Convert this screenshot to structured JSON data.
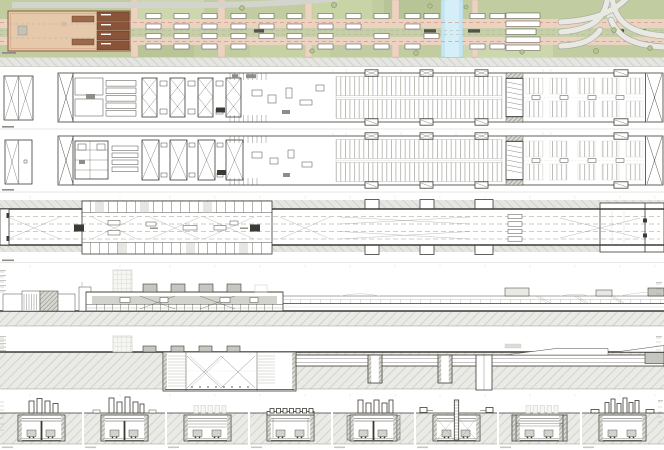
{
  "sheet": {
    "title": "Underground station – drawing sheet",
    "rows": [
      {
        "id": "site-plan",
        "label": "Site plan"
      },
      {
        "id": "level-minus-1-plan",
        "label": "Level -1 floor plan"
      },
      {
        "id": "level-minus-2-plan",
        "label": "Level -2 floor plan"
      },
      {
        "id": "platform-level-plan",
        "label": "Platform level plan"
      },
      {
        "id": "longitudinal-elevation",
        "label": "Longitudinal elevation"
      },
      {
        "id": "longitudinal-section",
        "label": "Longitudinal section"
      },
      {
        "id": "cross-sections",
        "label": "Cross sections"
      }
    ],
    "cross_section_count": 8
  },
  "colors": {
    "ink": "#3c3a34",
    "mid": "#8e8e87",
    "light": "#c8c8c2",
    "paper": "#ffffff",
    "grayfill": "#d3d3ce",
    "graybox": "#c6c6c0",
    "green": "#c1cda0",
    "green_light": "#cdd7ad",
    "green_dark": "#b7c496",
    "road_pink": "#ecd2c1",
    "road_line": "#c97f6b",
    "canal": "#c5e6f1",
    "canal_light": "#d6eef7",
    "building_tan": "#e6c9ab",
    "building_brown": "#8a5438",
    "building_midbrown": "#9c6a4a",
    "ramp_gray": "#e9e9e4",
    "ramp_edge": "#a8a8a1",
    "tree": "#7f9464"
  }
}
